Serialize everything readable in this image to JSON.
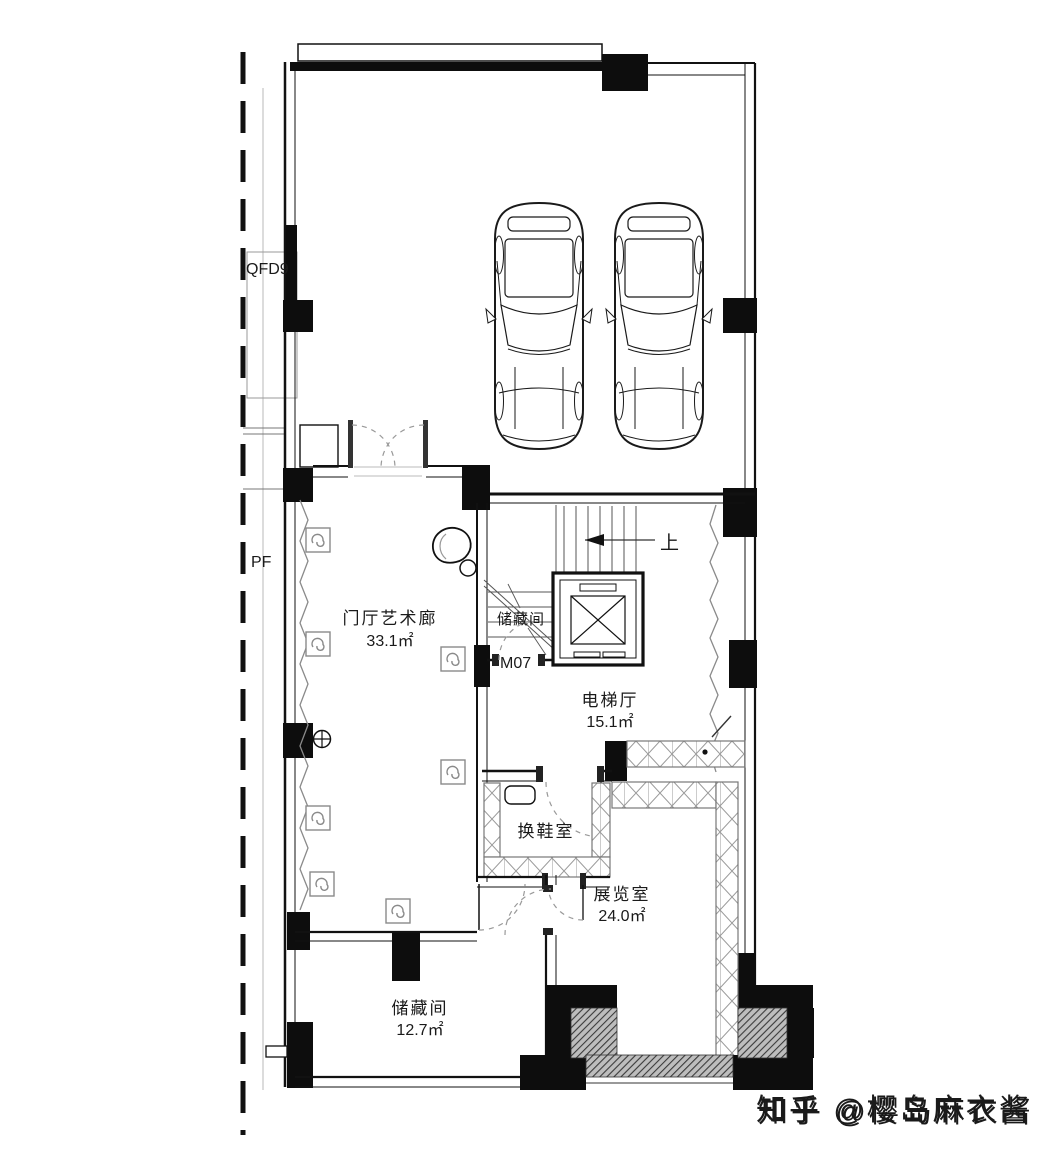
{
  "plan": {
    "boundary_labels": {
      "qfd9": "QFD9",
      "pf": "PF"
    },
    "door_label": "M07",
    "stair_direction": "上",
    "rooms": {
      "foyer": {
        "name": "门厅艺术廊",
        "area": "33.1㎡"
      },
      "understair_storage": {
        "name": "储藏间"
      },
      "elevator_hall": {
        "name": "电梯厅",
        "area": "15.1㎡"
      },
      "shoe_room": {
        "name": "换鞋室"
      },
      "exhibition_room": {
        "name": "展览室",
        "area": "24.0㎡"
      },
      "storage_room": {
        "name": "储藏间",
        "area": "12.7㎡"
      }
    }
  },
  "watermark": {
    "text": "知乎 @樱岛麻衣酱"
  },
  "colors": {
    "wall": "#111111",
    "hatch_dark": "#3a3a3a",
    "light_line": "#9a9a9a",
    "watermark": "#d2d2cf"
  }
}
